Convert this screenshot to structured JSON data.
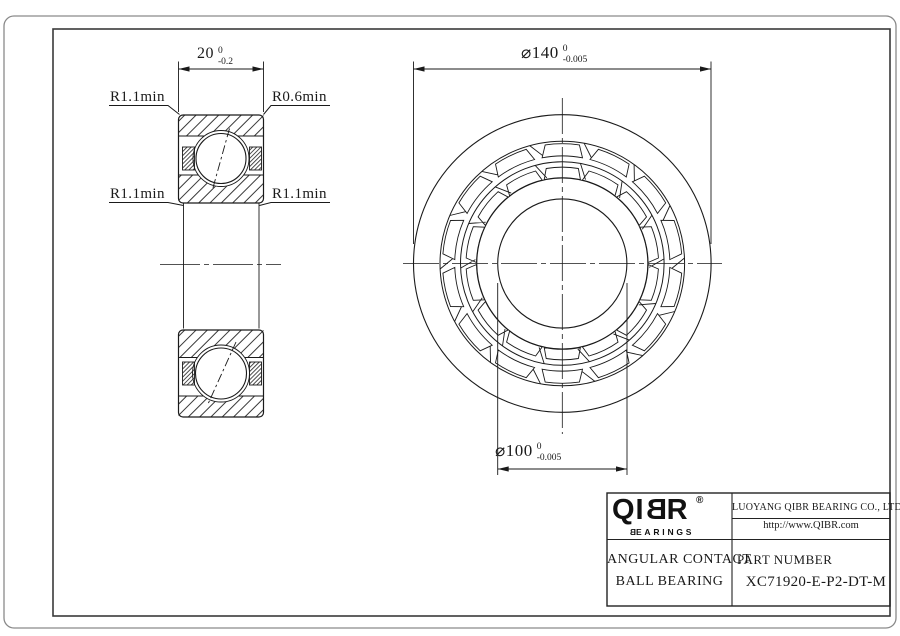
{
  "section": {
    "width_dim": {
      "value": "20",
      "tol_top": "0",
      "tol_bot": "-0.2"
    },
    "labels": {
      "top_left": "R1.1min",
      "top_right": "R0.6min",
      "mid_left": "R1.1min",
      "mid_right": "R1.1min"
    }
  },
  "front": {
    "od_dim": {
      "value": "⌀140",
      "tol_top": "0",
      "tol_bot": "-0.005"
    },
    "bore_dim": {
      "value": "⌀100",
      "tol_top": "0",
      "tol_bot": "-0.005"
    }
  },
  "title_block": {
    "logo": {
      "brand_pre": "QI",
      "brand_mirrored": "B",
      "brand_post": "R",
      "registered": "®",
      "sub_mirrored": "B",
      "sub_rest": "EARINGS"
    },
    "company": "LUOYANG QIBR BEARING CO., LTD",
    "website": "http://www.QIBR.com",
    "product_line1": "ANGULAR CONTACT",
    "product_line2": "BALL BEARING",
    "part_number_label": "PART NUMBER",
    "part_number": "XC71920-E-P2-DT-M"
  },
  "colors": {
    "ink": "#1a1a1a",
    "frame": "#3a3a3a",
    "border": "#8a8a8a"
  }
}
